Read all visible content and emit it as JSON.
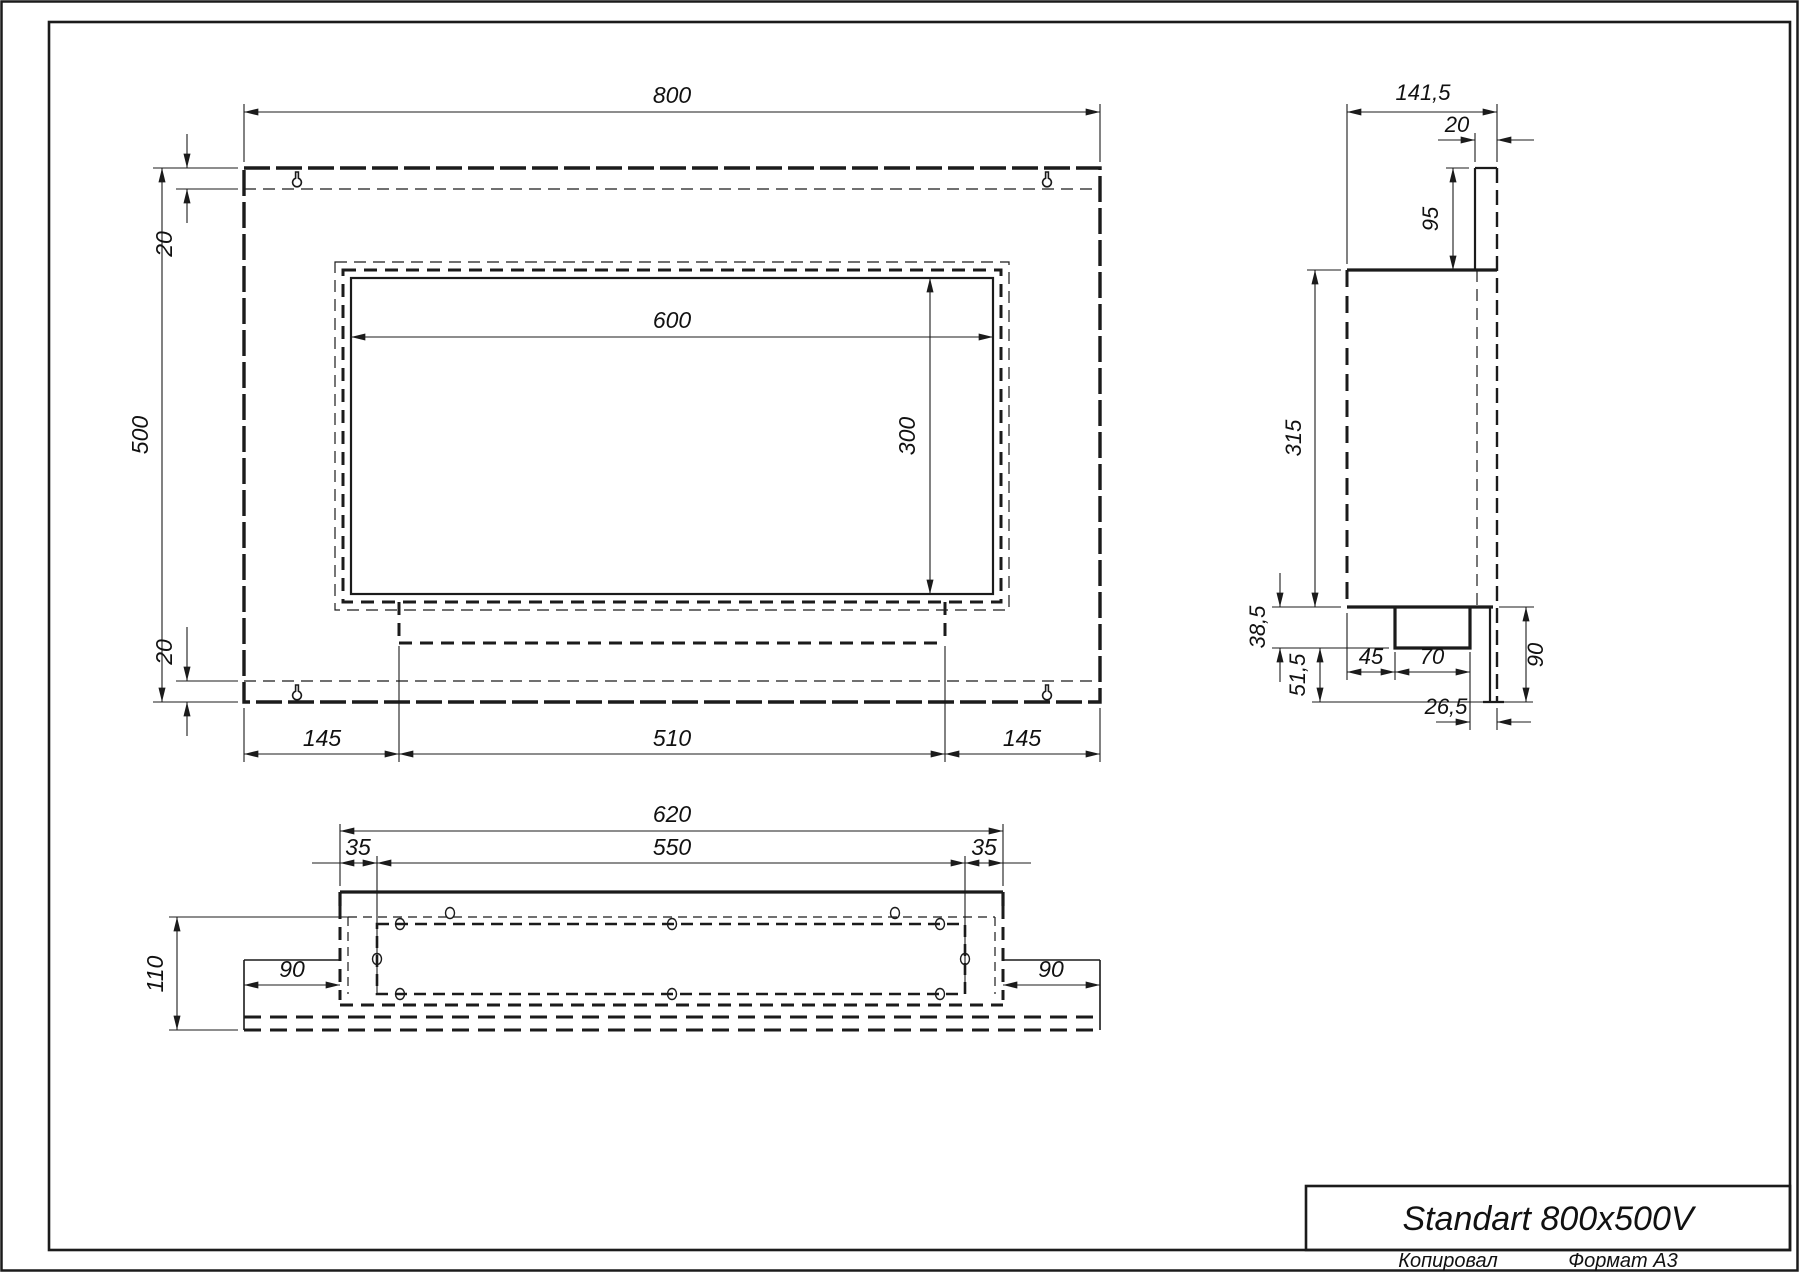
{
  "title_block": {
    "model": "Standart 800x500V"
  },
  "footer": {
    "copied_label": "Копировал",
    "format_label": "Формат А3"
  },
  "views": {
    "front": {
      "overall_width": "800",
      "overall_height": "500",
      "top_flange": "20",
      "bottom_flange": "20",
      "opening_width": "600",
      "opening_height": "300",
      "left_to_tray": "145",
      "tray_width": "510",
      "tray_to_right": "145"
    },
    "side": {
      "overall_depth": "141,5",
      "bracket_depth": "20",
      "top_to_box": "95",
      "box_height": "315",
      "tray_height": "38,5",
      "tray_to_bottom": "51,5",
      "front_to_tray": "45",
      "tray_depth": "70",
      "tray_to_back": "26,5",
      "bottom_plate": "90"
    },
    "bottom": {
      "box_width": "620",
      "inner_width": "550",
      "left_flange": "35",
      "right_flange": "35",
      "overall_depth": "110",
      "left_panel": "90",
      "right_panel": "90"
    }
  }
}
